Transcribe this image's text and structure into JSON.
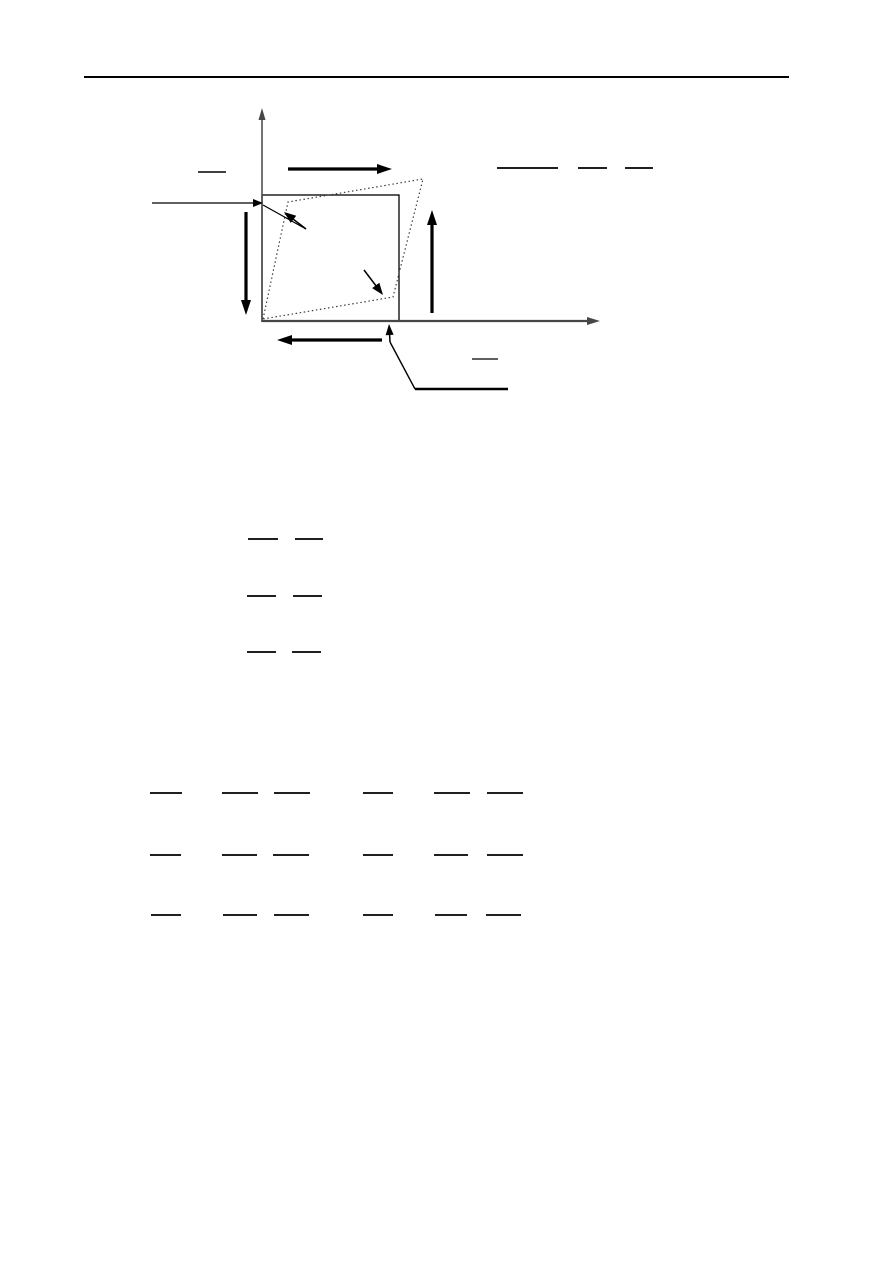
{
  "page": {
    "width": 893,
    "height": 1263,
    "background": "#ffffff"
  },
  "colors": {
    "ink": "#000000",
    "axis": "#474747",
    "dotted": "#3f3f3f"
  },
  "header": {
    "rule": {
      "x1": 84,
      "x2": 789,
      "y": 77,
      "thickness": 2,
      "color": "#000000"
    }
  },
  "figure": {
    "description": "square element under pure shear; dotted outline shows deformed shape",
    "square": {
      "x": 262,
      "y": 195,
      "width": 137,
      "height": 126,
      "stroke_width": 1.3
    },
    "deformed_outline": {
      "points": [
        [
          263,
          319
        ],
        [
          288,
          202
        ],
        [
          423,
          179
        ],
        [
          393,
          297
        ]
      ],
      "dash": "1.5,2.6",
      "stroke_width": 1.2
    },
    "axes": [
      {
        "name": "y-axis-arrow",
        "tail": [
          262,
          322
        ],
        "tip": [
          262,
          108
        ],
        "width": 1.5,
        "head": [
          12,
          7
        ]
      },
      {
        "name": "x-axis-arrow",
        "tail": [
          262,
          321
        ],
        "tip": [
          600,
          321
        ],
        "width": 2.2,
        "head": [
          13,
          8
        ]
      }
    ],
    "shear_arrows": [
      {
        "name": "top-shear-arrow",
        "tail": [
          288,
          169
        ],
        "tip": [
          392,
          169
        ],
        "width": 3.2,
        "head": [
          15,
          10
        ]
      },
      {
        "name": "right-shear-arrow",
        "tail": [
          432,
          313
        ],
        "tip": [
          432,
          210
        ],
        "width": 3.2,
        "head": [
          15,
          10
        ]
      },
      {
        "name": "left-shear-arrow",
        "tail": [
          246,
          212
        ],
        "tip": [
          246,
          315
        ],
        "width": 3.2,
        "head": [
          15,
          10
        ]
      },
      {
        "name": "bottom-shear-arrow",
        "tail": [
          382,
          340
        ],
        "tip": [
          277,
          340
        ],
        "width": 3.2,
        "head": [
          15,
          10
        ]
      }
    ],
    "pointers": [
      {
        "name": "left-leader-arrow",
        "tail": [
          152,
          203
        ],
        "tip": [
          263,
          203
        ],
        "width": 1.2,
        "head": [
          10,
          8
        ]
      },
      {
        "name": "deformed-edge-pointer",
        "tail": [
          306,
          229
        ],
        "tip": [
          284,
          212
        ],
        "width": 1.5,
        "head": [
          12,
          9
        ]
      },
      {
        "name": "lower-corner-pointer",
        "tail": [
          364,
          270
        ],
        "tip": [
          383,
          295
        ],
        "width": 1.5,
        "head": [
          12,
          9
        ]
      },
      {
        "name": "axis-pointer",
        "tail": [
          390,
          342
        ],
        "tip": [
          389,
          324
        ],
        "width": 1.5,
        "head": [
          11,
          8
        ]
      }
    ],
    "lines": [
      {
        "name": "corner-leader-tail",
        "from": [
          263,
          205
        ],
        "to": [
          306,
          229
        ],
        "width": 1.2
      },
      {
        "name": "upper-left-overbar",
        "from": [
          198,
          172
        ],
        "to": [
          226,
          172
        ],
        "width": 1.6
      },
      {
        "name": "top-right-bar-long",
        "from": [
          497,
          168
        ],
        "to": [
          558,
          168
        ],
        "width": 1.8
      },
      {
        "name": "top-right-bar-mid",
        "from": [
          578,
          168
        ],
        "to": [
          607,
          168
        ],
        "width": 1.8
      },
      {
        "name": "top-right-bar-short",
        "from": [
          625,
          168
        ],
        "to": [
          653,
          168
        ],
        "width": 1.8
      },
      {
        "name": "bottom-overbar",
        "from": [
          472,
          359
        ],
        "to": [
          498,
          359
        ],
        "width": 1.2
      },
      {
        "name": "label-leader-diagonal",
        "from": [
          415,
          389
        ],
        "to": [
          390,
          342
        ],
        "width": 1.4
      },
      {
        "name": "bottom-label-rule",
        "from": [
          415,
          389
        ],
        "to": [
          508,
          389
        ],
        "width": 2.4
      }
    ]
  },
  "equations": {
    "mid_fraction_bars": {
      "bar_thickness": 1.8,
      "rows": [
        {
          "y": 539,
          "bars": [
            [
              248,
              278
            ],
            [
              295,
              323
            ]
          ]
        },
        {
          "y": 596,
          "bars": [
            [
              247,
              276
            ],
            [
              293,
              322
            ]
          ]
        },
        {
          "y": 652,
          "bars": [
            [
              247,
              276
            ],
            [
              292,
              321
            ]
          ]
        }
      ]
    },
    "bottom_fraction_bars": {
      "bar_thickness": 1.8,
      "rows": [
        {
          "y": 793,
          "bars": [
            [
              150,
              182
            ],
            [
              222,
              258
            ],
            [
              274,
              310
            ],
            [
              363,
              393
            ],
            [
              434,
              470
            ],
            [
              487,
              523
            ]
          ]
        },
        {
          "y": 855,
          "bars": [
            [
              150,
              181
            ],
            [
              222,
              257
            ],
            [
              273,
              309
            ],
            [
              363,
              393
            ],
            [
              434,
              468
            ],
            [
              487,
              523
            ]
          ]
        },
        {
          "y": 915,
          "bars": [
            [
              151,
              181
            ],
            [
              223,
              257
            ],
            [
              274,
              309
            ],
            [
              363,
              393
            ],
            [
              435,
              467
            ],
            [
              486,
              521
            ]
          ]
        }
      ]
    }
  }
}
